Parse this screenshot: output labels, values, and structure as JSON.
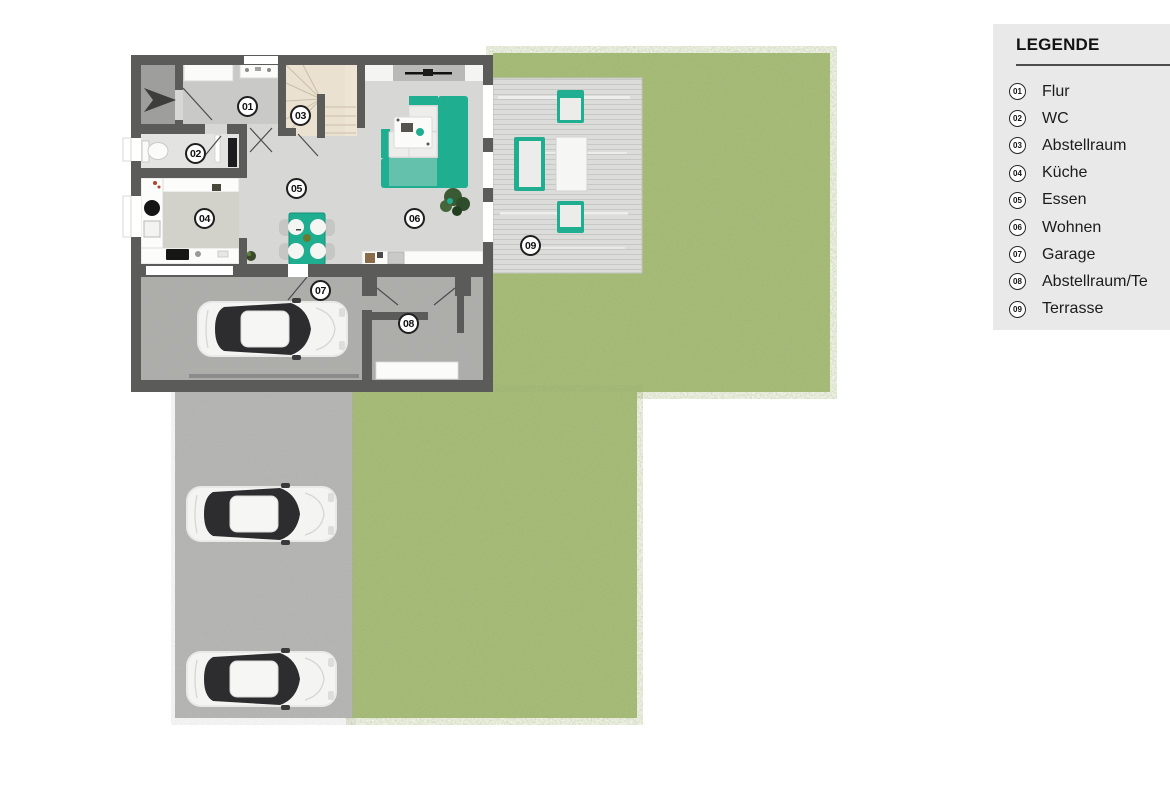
{
  "plan": {
    "badges": [
      "01",
      "02",
      "03",
      "04",
      "05",
      "06",
      "07",
      "08",
      "09"
    ]
  },
  "legend": {
    "title": "LEGENDE",
    "items": [
      {
        "num": "01",
        "label": "Flur"
      },
      {
        "num": "02",
        "label": "WC"
      },
      {
        "num": "03",
        "label": "Abstellraum"
      },
      {
        "num": "04",
        "label": "Küche"
      },
      {
        "num": "05",
        "label": "Essen"
      },
      {
        "num": "06",
        "label": "Wohnen"
      },
      {
        "num": "07",
        "label": "Garage"
      },
      {
        "num": "08",
        "label": "Abstellraum/Te"
      },
      {
        "num": "09",
        "label": "Terrasse"
      }
    ]
  },
  "colors": {
    "accent_teal": "#1fae90",
    "accent_teal_dark": "#149379",
    "wall_gray": "#5b5b59",
    "grass_green": "#a9bd7a",
    "driveway_gray": "#b6b6b4",
    "garage_floor_gray": "#adadab",
    "terrace_gray": "#dcdcda",
    "floor_light_gray": "#d7d7d5",
    "hall_floor_gray": "#c9c9c7",
    "stairs_beige": "#eae1d0",
    "legend_bg": "#e9e9e9",
    "car_white": "#f2f2f0"
  },
  "icons": {
    "entry_arrow": "➤"
  }
}
